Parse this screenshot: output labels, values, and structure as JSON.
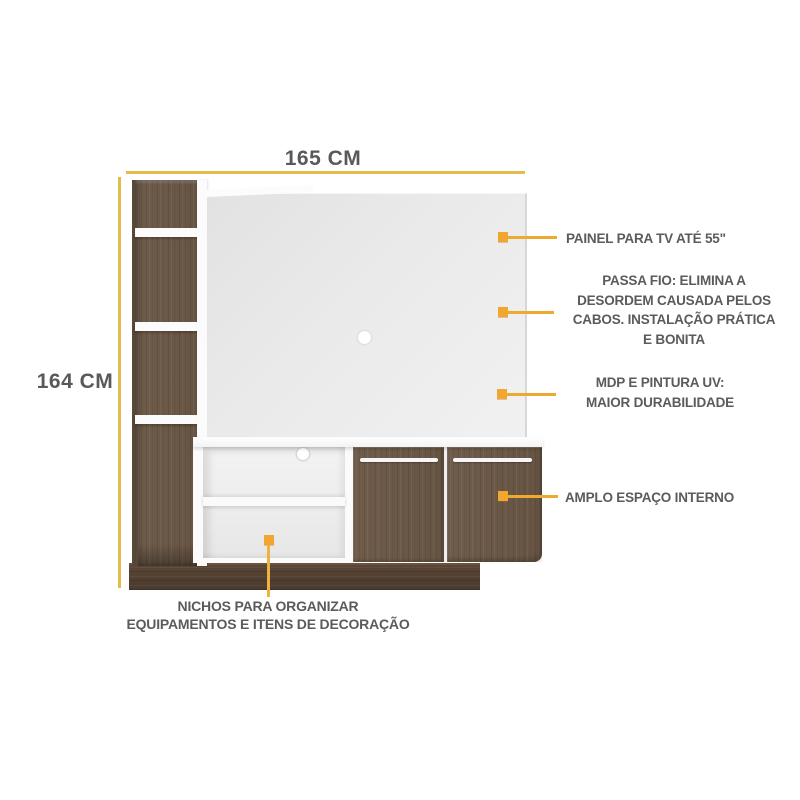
{
  "dimensions": {
    "width": {
      "label": "165 CM"
    },
    "height": {
      "label": "164 CM"
    }
  },
  "callouts": {
    "tv_panel": {
      "label": "PAINEL PARA TV ATÉ 55\""
    },
    "cable_pass": {
      "lines": [
        "PASSA FIO: ELIMINA A",
        "DESORDEM CAUSADA PELOS",
        "CABOS. INSTALAÇÃO PRÁTICA",
        "E BONITA"
      ]
    },
    "mdp": {
      "lines": [
        "MDP E PINTURA UV:",
        "MAIOR DURABILIDADE"
      ]
    },
    "interior": {
      "label": "AMPLO ESPAÇO INTERNO"
    },
    "niches": {
      "lines": [
        "NICHOS PARA ORGANIZAR",
        "EQUIPAMENTOS E ITENS DE DECORAÇÃO"
      ]
    }
  },
  "colors": {
    "accent_marker": "#F0A62F",
    "dimension_line": "#E3BC4E",
    "text": "#5B5B5B",
    "wood": "#6B5847",
    "wood_dark": "#4E3D30",
    "panel_gray": "#EAEAEA",
    "white_part": "#FBFBFB"
  }
}
